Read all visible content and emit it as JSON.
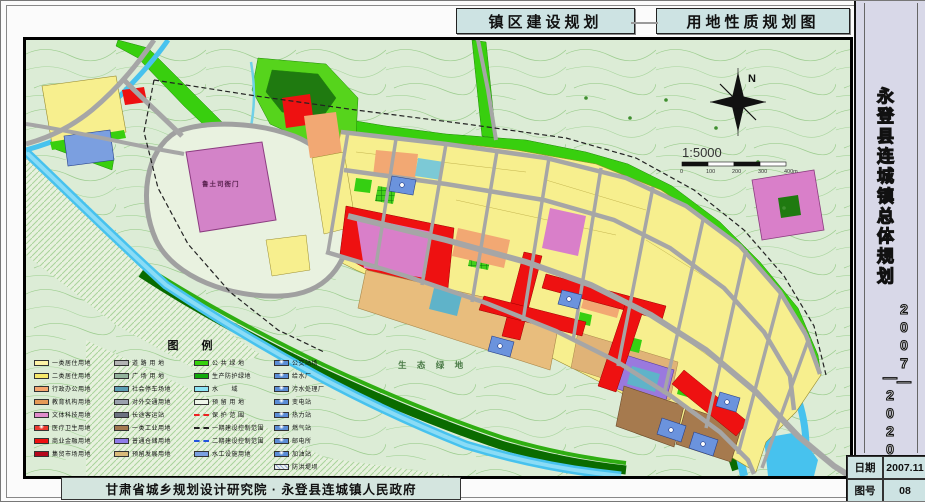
{
  "header": {
    "left_title": "镇区建设规划",
    "right_title": "用地性质规划图"
  },
  "sidebar": {
    "title": "永登县连城镇总体规划",
    "years_top": "2007—",
    "years_bottom": "—2020"
  },
  "footer": {
    "credit": "甘肃省城乡规划设计研究院 · 永登县连城镇人民政府"
  },
  "info_table": {
    "rows": [
      {
        "label": "日期",
        "value": "2007.11"
      },
      {
        "label": "图号",
        "value": "08"
      }
    ]
  },
  "map": {
    "labels": {
      "eco_green": "生 态 绿 地",
      "heritage": "鲁土司衙门",
      "north": "N",
      "scale": "1:5000"
    },
    "scale_ticks": [
      "0",
      "100",
      "200",
      "300",
      "400m"
    ]
  },
  "legend": {
    "title": "图  例",
    "columns": [
      {
        "items": [
          {
            "l": "一类居住用地",
            "t": "fill",
            "c": "#fdf3a6"
          },
          {
            "l": "二类居住用地",
            "t": "fill",
            "c": "#f6e96a"
          },
          {
            "l": "行政办公用地",
            "t": "fill",
            "c": "#f5a76f"
          },
          {
            "l": "教育机构用地",
            "t": "fill",
            "c": "#e59a57"
          },
          {
            "l": "文体科技用地",
            "t": "fill",
            "c": "#e18ccb"
          },
          {
            "l": "医疗卫生用地",
            "t": "sym",
            "c": "#e93a2f"
          },
          {
            "l": "商业金融用地",
            "t": "fill",
            "c": "#ee1111"
          },
          {
            "l": "集贸市场用地",
            "t": "fill",
            "c": "#b5071c"
          }
        ]
      },
      {
        "items": [
          {
            "l": "道 路 用 地",
            "t": "fill",
            "c": "#b3b3b3"
          },
          {
            "l": "广 场 用 地",
            "t": "fill",
            "c": "#93b39c"
          },
          {
            "l": "社会停车场地",
            "t": "fill",
            "c": "#5c9fb5"
          },
          {
            "l": "对外交通用地",
            "t": "fill",
            "c": "#9aa0ad"
          },
          {
            "l": "长途客运站",
            "t": "fill",
            "c": "#6b7280"
          },
          {
            "l": "一类工业用地",
            "t": "fill",
            "c": "#a3794f"
          },
          {
            "l": "普通仓储用地",
            "t": "fill",
            "c": "#8f7ce8"
          },
          {
            "l": "预留发展用地",
            "t": "fill",
            "c": "#d9ba7a"
          }
        ]
      },
      {
        "items": [
          {
            "l": "公 共 绿 地",
            "t": "fill",
            "c": "#35d10c"
          },
          {
            "l": "生产防护绿地",
            "t": "fill",
            "c": "#11a80b"
          },
          {
            "l": "水　　域",
            "t": "fill",
            "c": "#8ce4f5"
          },
          {
            "l": "预 留 用 地",
            "t": "fill",
            "c": "#eef6e8"
          },
          {
            "l": "保 护 范 围",
            "t": "dash",
            "c": "#ee2222"
          },
          {
            "l": "一期建设控制范围",
            "t": "dash",
            "c": "#222222"
          },
          {
            "l": "二期建设控制范围",
            "t": "dash",
            "c": "#2255dd"
          },
          {
            "l": "水工设施用地",
            "t": "fill",
            "c": "#7b9fe0"
          }
        ]
      },
      {
        "items": [
          {
            "l": "公交站场",
            "t": "sym",
            "c": "#5b8dd6"
          },
          {
            "l": "给水厂",
            "t": "sym",
            "c": "#5b8dd6"
          },
          {
            "l": "污水处理厂",
            "t": "sym",
            "c": "#5b8dd6"
          },
          {
            "l": "变电站",
            "t": "sym",
            "c": "#5b8dd6"
          },
          {
            "l": "热力站",
            "t": "sym",
            "c": "#5b8dd6"
          },
          {
            "l": "燃气站",
            "t": "sym",
            "c": "#5b8dd6"
          },
          {
            "l": "邮电所",
            "t": "sym",
            "c": "#5b8dd6"
          },
          {
            "l": "加油站",
            "t": "sym",
            "c": "#5b8dd6"
          },
          {
            "l": "防洪堤坝",
            "t": "hatch",
            "c": "#9fb3d9"
          }
        ]
      }
    ]
  },
  "colors": {
    "residential_yellow": "#f7ef8e",
    "commercial_red": "#ee1111",
    "cultural_pink": "#d97fc9",
    "industrial_brown": "#a67a4e",
    "storage_purple": "#9a79de",
    "reserve_tan": "#e8bd7d",
    "green_space": "#38cf0e",
    "water_blue": "#47c2ee",
    "road_gray": "#a6a6a6",
    "panel_cyan": "#cde3e3",
    "sidebar_lavender": "#d8d8e8"
  }
}
